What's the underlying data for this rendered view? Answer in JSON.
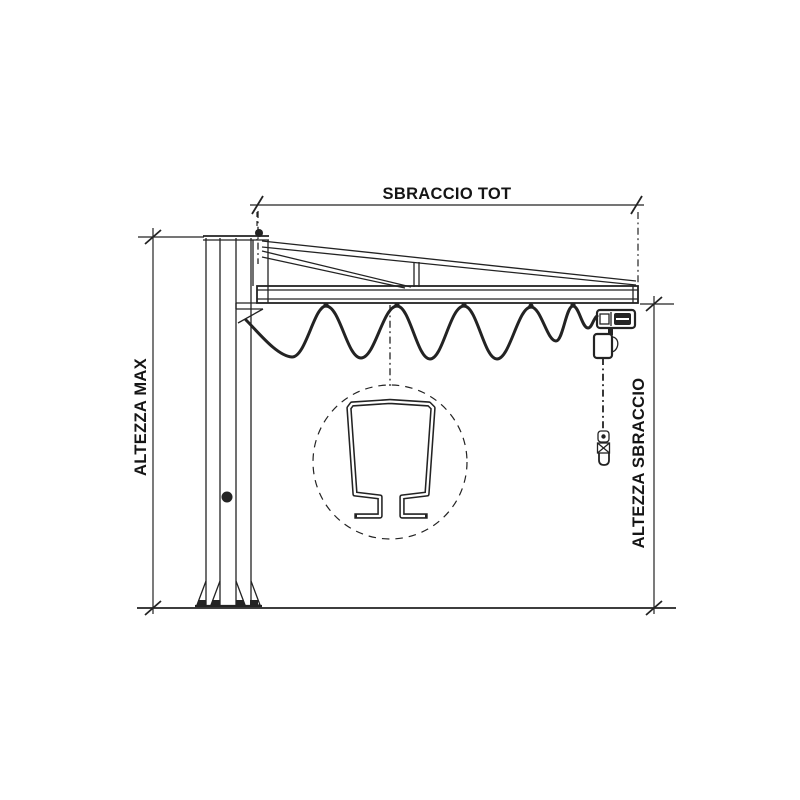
{
  "title": "Column-mounted jib crane dimensional drawing",
  "labels": {
    "sbraccio_tot": "SBRACCIO TOT",
    "altezza_max": "ALTEZZA MAX",
    "altezza_sbraccio": "ALTEZZA SBRACCIO"
  },
  "colors": {
    "line": "#232323",
    "background": "#ffffff",
    "text": "#151515"
  }
}
